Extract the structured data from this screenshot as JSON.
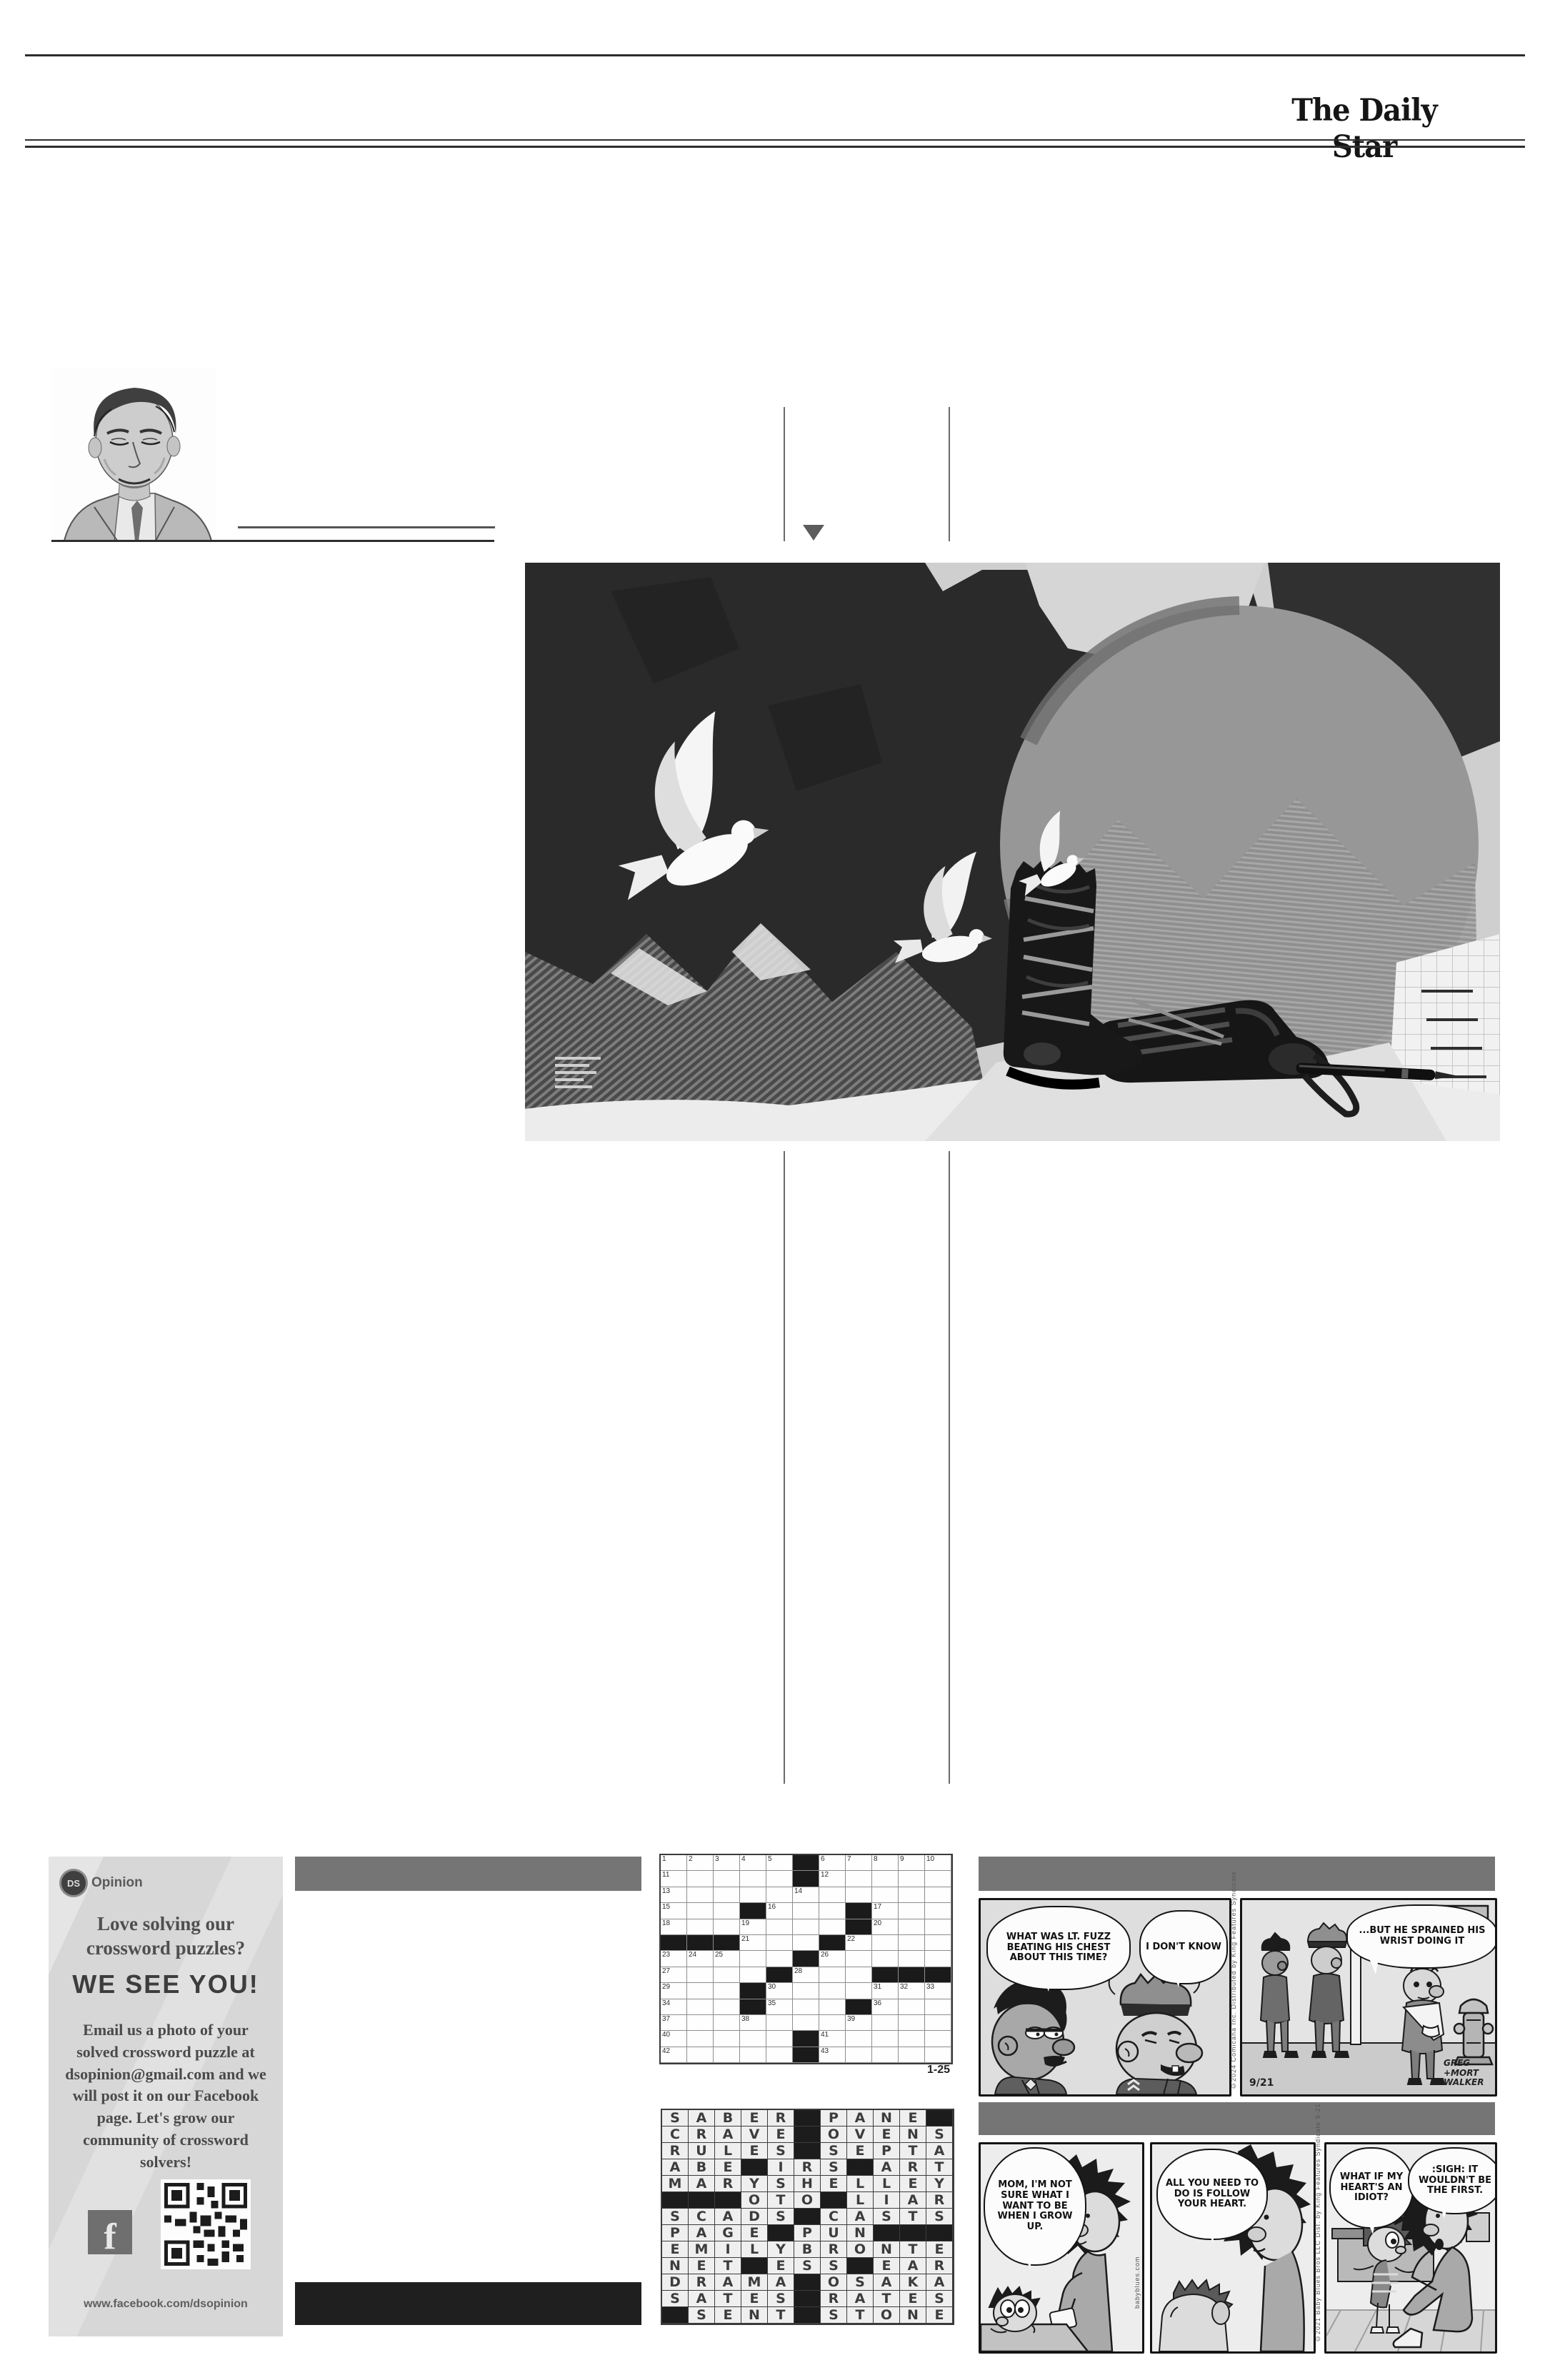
{
  "masthead": "The Daily Star",
  "promo": {
    "logo_badge": "DS",
    "logo_text": "Opinion",
    "headline1": "Love solving our",
    "headline2": "crossword puzzles?",
    "shout": "WE SEE YOU!",
    "body": "Email us a photo of your solved crossword puzzle at dsopinion@gmail.com and we will post it on our Facebook page. Let's grow our community of crossword solvers!",
    "facebook_letter": "f",
    "url": "www.facebook.com/dsopinion"
  },
  "crossword": {
    "rows": 13,
    "cols": 11,
    "date_label": "1-25",
    "black_cells": [
      [
        1,
        6
      ],
      [
        2,
        6
      ],
      [
        4,
        4
      ],
      [
        4,
        8
      ],
      [
        5,
        8
      ],
      [
        6,
        1
      ],
      [
        6,
        2
      ],
      [
        6,
        3
      ],
      [
        6,
        7
      ],
      [
        7,
        6
      ],
      [
        8,
        5
      ],
      [
        8,
        9
      ],
      [
        8,
        10
      ],
      [
        8,
        11
      ],
      [
        9,
        4
      ],
      [
        10,
        4
      ],
      [
        10,
        8
      ],
      [
        12,
        6
      ],
      [
        13,
        6
      ]
    ],
    "numbers": [
      [
        1,
        1,
        1
      ],
      [
        1,
        2,
        2
      ],
      [
        1,
        3,
        3
      ],
      [
        1,
        4,
        4
      ],
      [
        1,
        5,
        5
      ],
      [
        1,
        7,
        6
      ],
      [
        1,
        8,
        7
      ],
      [
        1,
        9,
        8
      ],
      [
        1,
        10,
        9
      ],
      [
        1,
        11,
        10
      ],
      [
        2,
        1,
        11
      ],
      [
        2,
        7,
        12
      ],
      [
        3,
        1,
        13
      ],
      [
        3,
        6,
        14
      ],
      [
        4,
        1,
        15
      ],
      [
        4,
        5,
        16
      ],
      [
        4,
        9,
        17
      ],
      [
        5,
        1,
        18
      ],
      [
        5,
        4,
        19
      ],
      [
        5,
        9,
        20
      ],
      [
        6,
        4,
        21
      ],
      [
        6,
        8,
        22
      ],
      [
        7,
        1,
        23
      ],
      [
        7,
        2,
        24
      ],
      [
        7,
        3,
        25
      ],
      [
        7,
        7,
        26
      ],
      [
        8,
        1,
        27
      ],
      [
        8,
        6,
        28
      ],
      [
        9,
        1,
        29
      ],
      [
        9,
        5,
        30
      ],
      [
        9,
        9,
        31
      ],
      [
        9,
        10,
        32
      ],
      [
        9,
        11,
        33
      ],
      [
        10,
        1,
        34
      ],
      [
        10,
        5,
        35
      ],
      [
        10,
        9,
        36
      ],
      [
        11,
        1,
        37
      ],
      [
        11,
        4,
        38
      ],
      [
        11,
        8,
        39
      ],
      [
        12,
        1,
        40
      ],
      [
        12,
        7,
        41
      ],
      [
        13,
        1,
        42
      ],
      [
        13,
        7,
        43
      ]
    ]
  },
  "solution": {
    "rows": [
      "SABER.PANE.",
      "CRAVE.OVENS",
      "RULES.SEPTA",
      "ABE.IRS.ART",
      "MARYSHELLEY",
      "...OTO.LIAR",
      "SCADS.CASTS",
      "PAGE.PUN...",
      "EMILYBRONTE",
      "NET.ESS.EAR",
      "DRAMA.OSAKA",
      "SATES.RATES",
      ".SENT.STONE"
    ]
  },
  "comics": {
    "beetle": {
      "bubble1": "WHAT WAS LT. FUZZ BEATING HIS CHEST ABOUT THIS TIME?",
      "bubble2": "I DON'T KNOW",
      "bubble3": "...BUT HE SPRAINED HIS WRIST DOING IT",
      "date": "9/21",
      "signature": "GREG +MORT WALKER",
      "copyright": "©2024 Comicana Inc.  Distributed by King Features Syndicate"
    },
    "baby_blues": {
      "bubble1": "MOM, I'M NOT SURE WHAT I WANT TO BE WHEN I GROW UP.",
      "bubble2": "ALL YOU NEED TO DO IS FOLLOW YOUR HEART.",
      "bubble3": "WHAT IF MY HEART'S AN IDIOT?",
      "bubble4": ":SIGH: IT WOULDN'T BE THE FIRST.",
      "site": "babyblues.com",
      "copyright": "©2021 Baby Blues Bros LLC  Dist. by King Features Syndicate  9-21"
    }
  }
}
